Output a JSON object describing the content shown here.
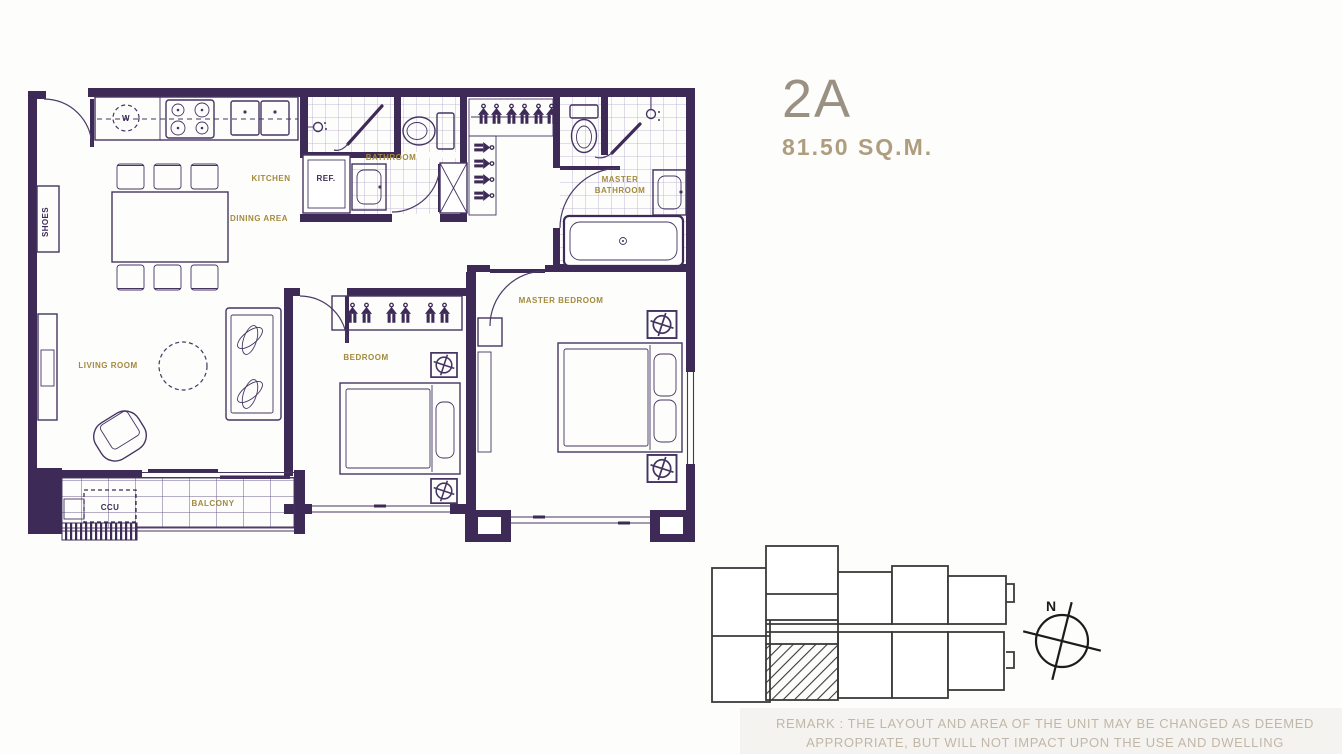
{
  "title": {
    "unit_name": "2A",
    "unit_area": "81.50 SQ.M."
  },
  "plan": {
    "labels": {
      "kitchen": "KITCHEN",
      "dining_area": "DINING AREA",
      "living_room": "LIVING ROOM",
      "bedroom": "BEDROOM",
      "master_bedroom": "MASTER BEDROOM",
      "bathroom": "BATHROOM",
      "master_bathroom_line1": "MASTER",
      "master_bathroom_line2": "BATHROOM",
      "balcony": "BALCONY",
      "ccu": "CCU",
      "ref": "REF.",
      "shoes": "SHOES",
      "washer": "W"
    }
  },
  "compass": {
    "north": "N"
  },
  "remark": {
    "line1": "REMARK : THE LAYOUT AND AREA OF THE UNIT MAY BE CHANGED AS DEEMED",
    "line2": "APPROPRIATE, BUT WILL NOT IMPACT UPON THE USE AND DWELLING"
  },
  "colors": {
    "wall": "#3e2a57",
    "room_label": "#a28a3e",
    "unit_name": "#9b9183",
    "unit_area": "#ae9d7e",
    "remark_text": "#c1b7a8",
    "key_plan_line": "#3a3a3a"
  }
}
